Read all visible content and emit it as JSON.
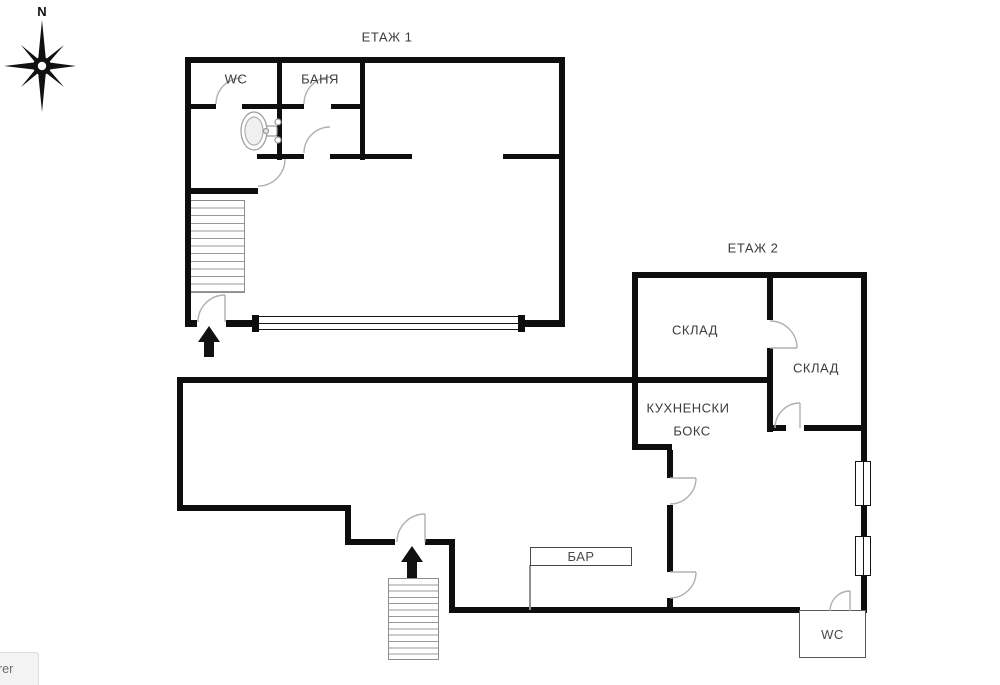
{
  "compass": {
    "north": "N"
  },
  "floor1": {
    "title": "ЕТАЖ 1",
    "rooms": {
      "wc": "WC",
      "bath": "БАНЯ"
    }
  },
  "floor2": {
    "title": "ЕТАЖ 2",
    "rooms": {
      "storage_left": "СКЛАД",
      "storage_right": "СКЛАД",
      "kitchen_line1": "КУХНЕНСКИ",
      "kitchen_line2": "БОКС",
      "bar": "БАР",
      "wc": "WC"
    }
  },
  "status_bar": {
    "text": "rer"
  },
  "colors": {
    "wall": "#0e0e0e",
    "thin_line": "#b0b0b0",
    "label": "#3c3c3c"
  }
}
